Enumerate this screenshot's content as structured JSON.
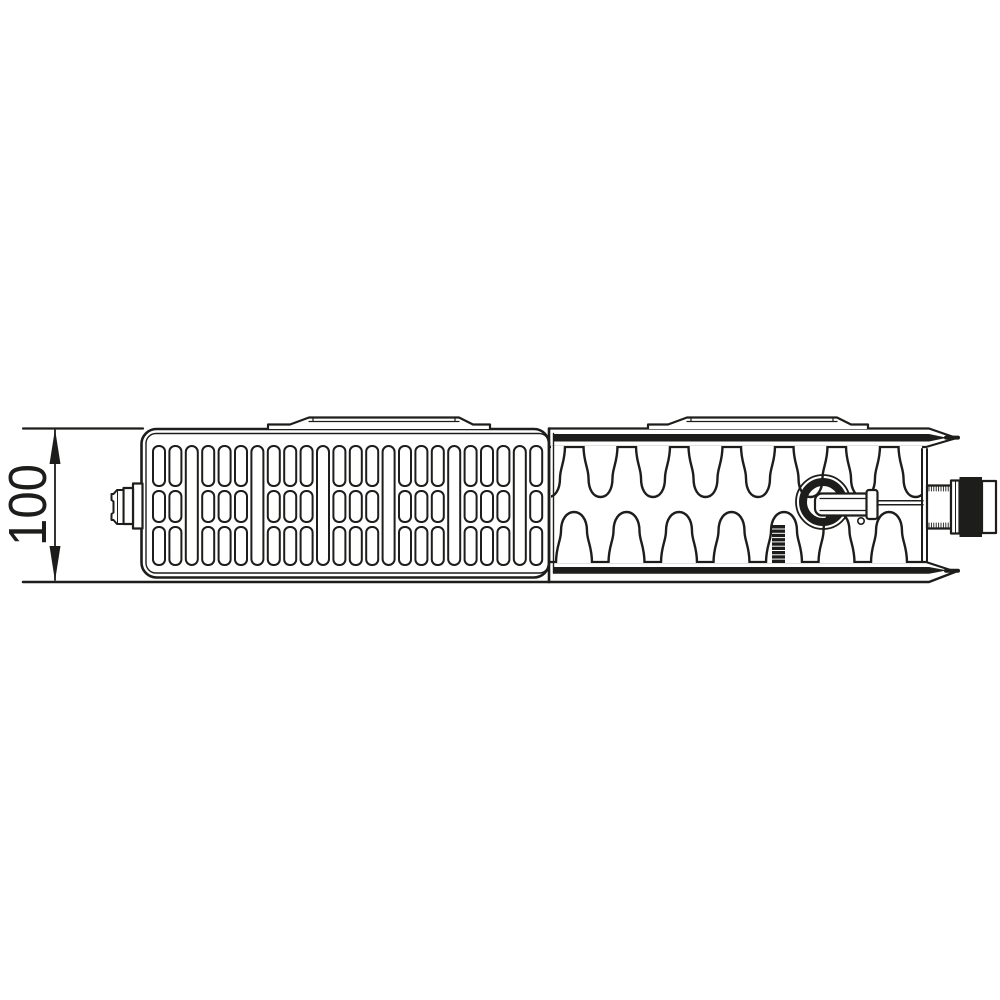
{
  "figure": {
    "background": "#ffffff",
    "line_color": "#1d1d1b",
    "dimension": {
      "label": "100"
    },
    "parts": [
      "depth-dimension",
      "grille-panel",
      "mounting-bracket",
      "convector-fins",
      "valve-body",
      "valve-spindle",
      "valve-connection-nipple",
      "protection-cap",
      "air-vent-plug"
    ],
    "grille": {
      "column_count": 24,
      "tall_every": 4,
      "black_middle_columns": [
        1,
        16
      ]
    },
    "fins": {
      "top_count": 8,
      "bottom_count": 7
    },
    "brackets": {
      "count": 2
    }
  }
}
